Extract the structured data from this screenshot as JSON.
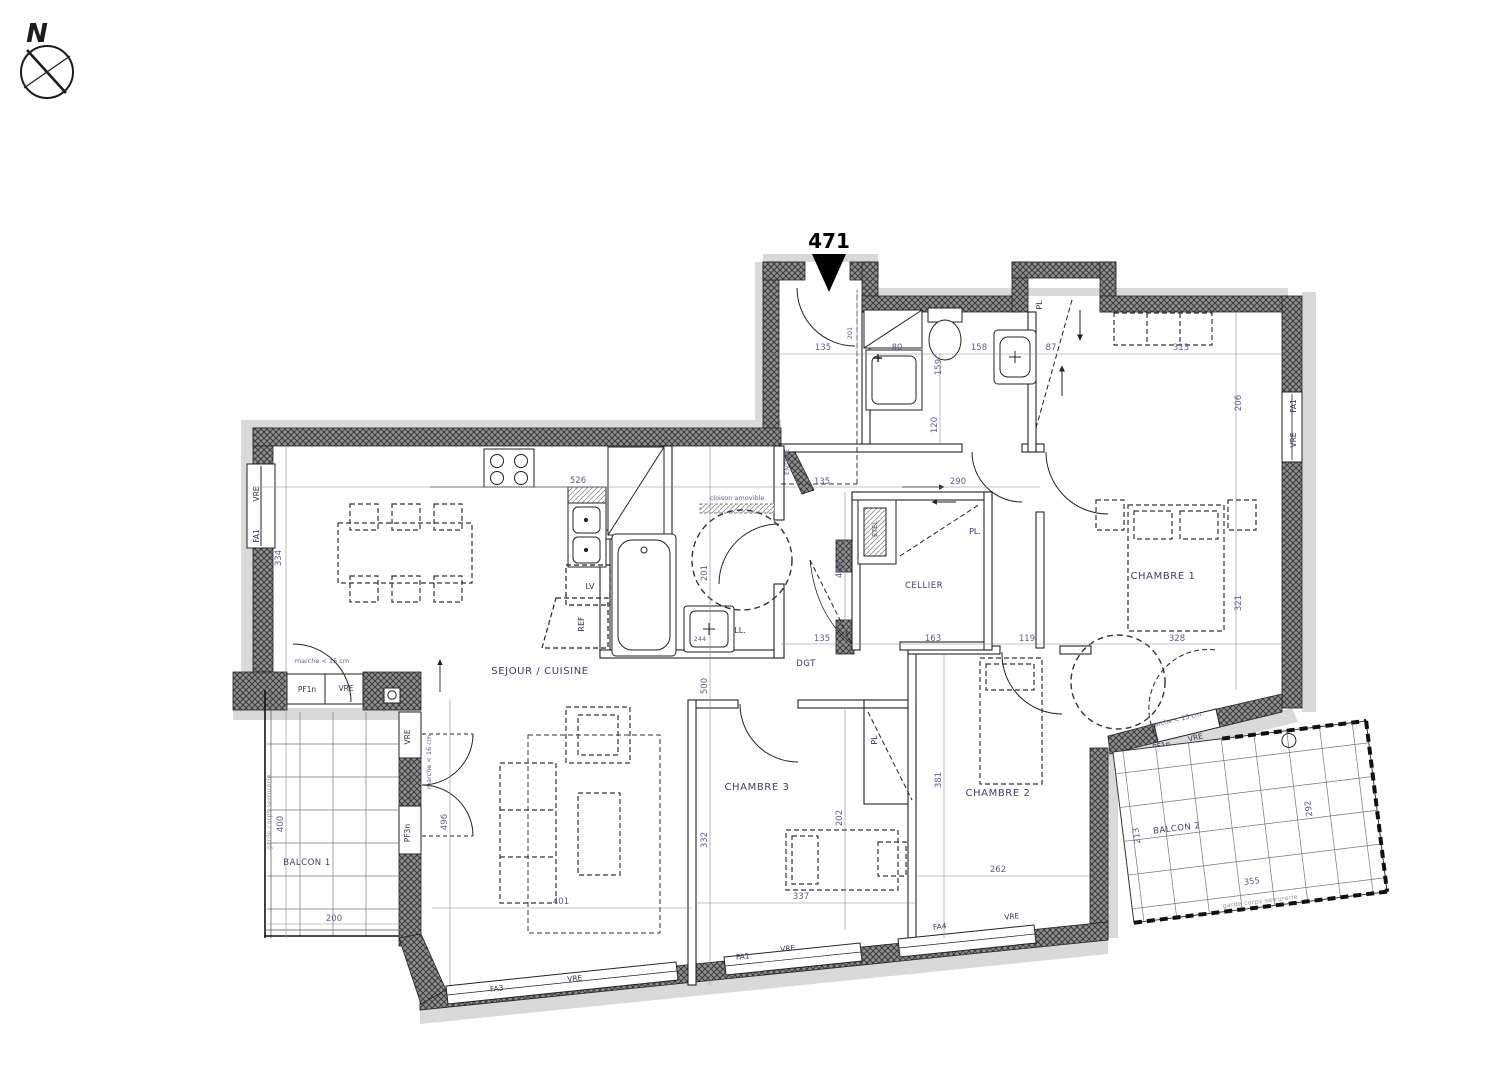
{
  "unit": "471",
  "compass": "N",
  "rooms": [
    "SEJOUR / CUISINE",
    "CHAMBRE 1",
    "CHAMBRE 2",
    "CHAMBRE 3",
    "CELLIER",
    "DGT",
    "BALCON 1",
    "BALCON 2"
  ],
  "fixtures": [
    "LV",
    "REF",
    "LL.",
    "ETEL",
    "PL.",
    "PL",
    "PL"
  ],
  "windows": [
    {
      "tag": "FA1",
      "shutter": "VRE"
    },
    {
      "tag": "PF1n",
      "shutter": "VRE"
    },
    {
      "tag": "VRE"
    },
    {
      "tag": "PF3n"
    },
    {
      "tag": "FA3",
      "shutter": "VRE"
    },
    {
      "tag": "FA1",
      "shutter": "VRE"
    },
    {
      "tag": "FA4",
      "shutter": "VRE"
    },
    {
      "tag": "PF1n",
      "shutter": "VRE"
    },
    {
      "tag": "FA1",
      "shutter": "VRE"
    }
  ],
  "notes": [
    "marche < 15 cm",
    "marche < 16 cm",
    "marche < 15 cm",
    "cloison amovible",
    "garde corps serrurerie",
    "garde corps serrurerie",
    "ENTREE"
  ],
  "dims": [
    "526",
    "334",
    "135",
    "201",
    "80",
    "159",
    "158",
    "87",
    "313",
    "206",
    "120",
    "135",
    "290",
    "464",
    "163",
    "119",
    "135",
    "328",
    "321",
    "201",
    "500",
    "332",
    "401",
    "337",
    "496",
    "400",
    "200",
    "262",
    "381",
    "202",
    "213",
    "355",
    "292",
    "244"
  ],
  "colors": {
    "dim_text": "#5b5e8f",
    "label_text": "#3c4066",
    "wall_hatch": "#8f8f8f",
    "slab_gray": "#d9d9d9"
  }
}
